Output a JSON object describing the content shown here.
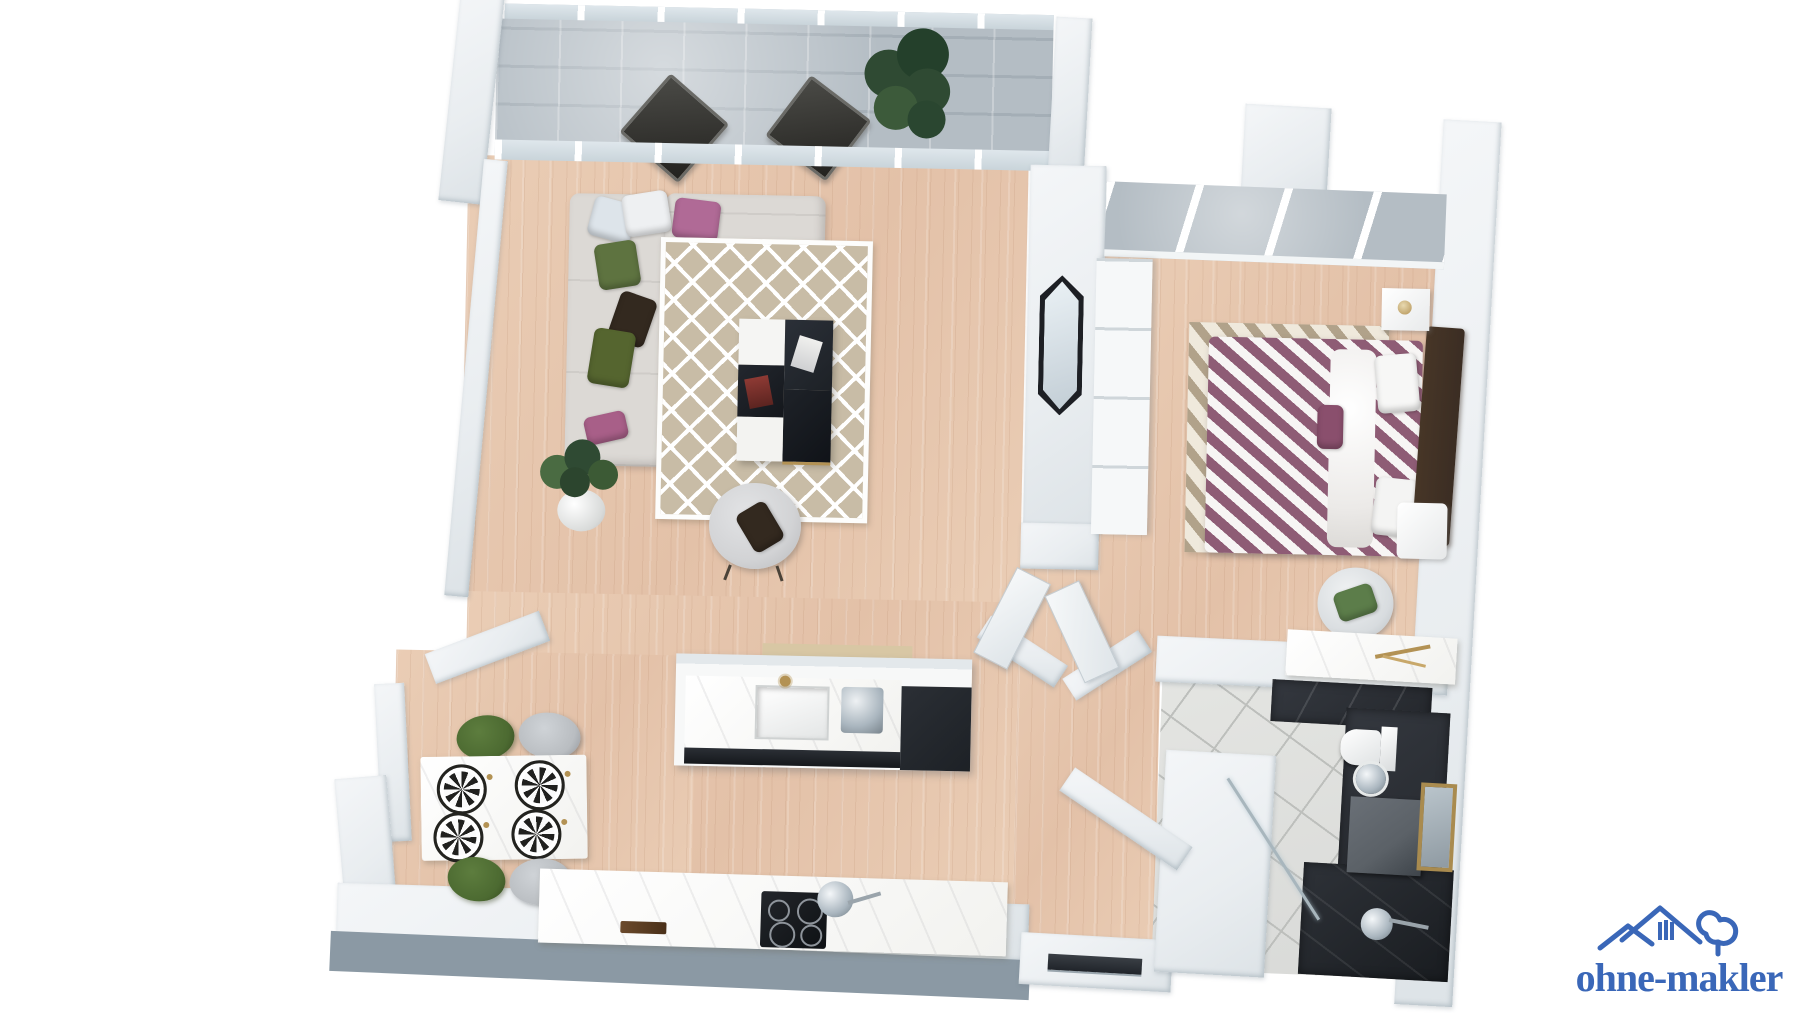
{
  "watermark": {
    "text": "ohne-makler"
  },
  "scene": {
    "type": "3d-floor-plan-render",
    "rooms": [
      "balcony",
      "living-room",
      "dining-area",
      "kitchen",
      "hallway",
      "bedroom",
      "bathroom"
    ],
    "furniture": {
      "balcony": [
        "folding-chair",
        "folding-chair",
        "potted-plant"
      ],
      "living_room": [
        "corner-sofa",
        "pillows",
        "geometric-rug",
        "block-coffee-table",
        "armchair",
        "potted-plant",
        "magazines"
      ],
      "dining_area": [
        "marble-dining-table",
        "green-chair",
        "green-chair",
        "gray-chair",
        "gray-chair",
        "patterned-plates"
      ],
      "kitchen": [
        "island-with-sink",
        "gold-faucet",
        "coffee-machine",
        "black-cabinets",
        "counter-with-cooktop",
        "pan",
        "cutting-board"
      ],
      "bedroom": [
        "double-bed-striped-bedding",
        "chevron-rug",
        "headboard",
        "nightstand",
        "bench",
        "wardrobe",
        "wall-mirror",
        "desk",
        "desk-chair"
      ],
      "bathroom": [
        "toilet",
        "round-basin",
        "vanity",
        "gold-framed-mirror",
        "walk-in-shower",
        "glass-partition"
      ]
    }
  },
  "colors": {
    "bg": "#ffffff",
    "wall": "#e9edf0",
    "wall_band": "#8b99a4",
    "wood": "#eacdb5",
    "concrete": "#b4bdc4",
    "glass": "#c9d4da",
    "rug_base": "#c8bca6",
    "rug2_base": "#d6cdbd",
    "rug2_stripe": "#b1a28a",
    "sofa": "#dcd9d5",
    "pil_green": "#5e7340",
    "pil_dark": "#33291f",
    "pil_pink": "#b06a96",
    "pil_silver": "#dde4ea",
    "armchair": "#d2d3d5",
    "table_white": "#f2f2ef",
    "black": "#1d2126",
    "chrome": "#aab6bf",
    "gold": "#b39254",
    "bed_stripe": "#8e5c75",
    "bed_white": "#f7f5f4",
    "headboard": "#3b2d23",
    "green_chair": "#4c6a31",
    "gray_chair": "#b9bdc1",
    "bath_dark": "#24272c",
    "bath_tile": "#d8d9d7",
    "tile_line": "#bdbfbc",
    "vanity": "#5b6167",
    "plant": "#2f4a33",
    "plant2": "#4a6b42",
    "logo_blue": "#3a67b8"
  }
}
